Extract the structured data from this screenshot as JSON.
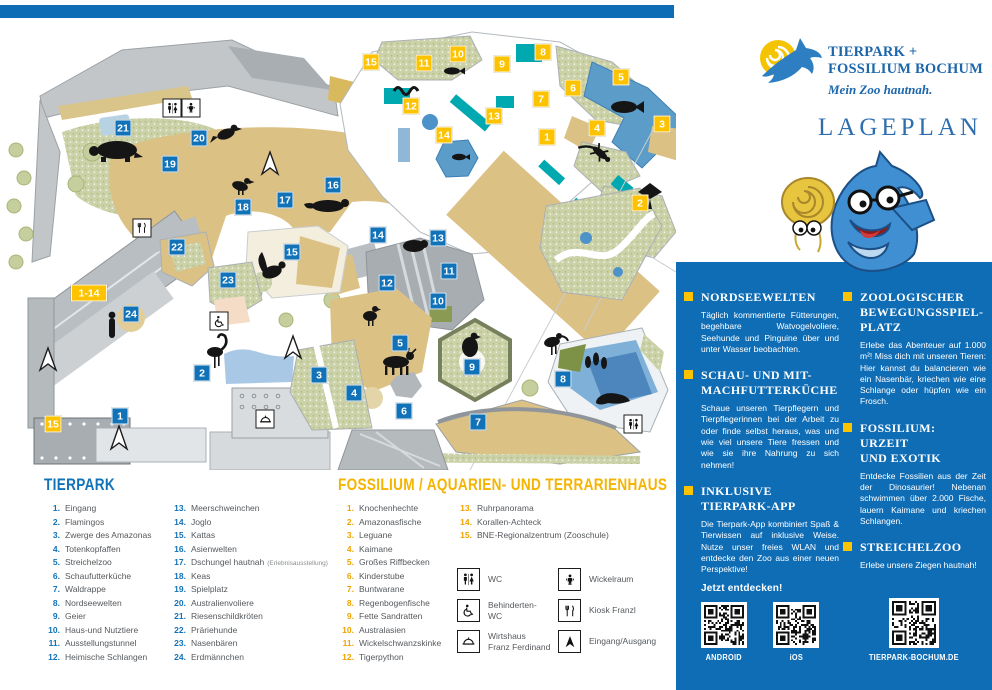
{
  "colors": {
    "brand_blue": "#0f6db6",
    "marker_blue": "#1272b8",
    "accent_yellow": "#fdc300"
  },
  "brand": {
    "line1": "TIERPARK +",
    "line2": "FOSSILIUM BOCHUM",
    "tagline": "Mein Zoo hautnah.",
    "page_title": "LAGEPLAN"
  },
  "sidebar": {
    "sections_left": [
      {
        "title": "NORDSEEWELTEN",
        "body": "Täglich kommentierte Fütterungen, begehbare Watvogelvoliere, Seehunde und Pinguine über und unter Wasser beobachten."
      },
      {
        "title": "SCHAU- UND MIT-\nMACHFUTTERKÜCHE",
        "body": "Schaue unseren Tierpflegern und Tierpflegerinnen bei der Arbeit zu oder finde selbst heraus, was und wie viel unsere Tiere fressen und wie sie ihre Nahrung zu sich nehmen!"
      },
      {
        "title": "INKLUSIVE\nTIERPARK-APP",
        "body": "Die Tierpark-App kombiniert Spaß & Tierwissen auf inklusive Weise. Nutze unser freies WLAN und entdecke den Zoo aus einer neuen Perspektive!",
        "cta": "Jetzt entdecken!"
      }
    ],
    "sections_right": [
      {
        "title": "ZOOLOGISCHER\nBEWEGUNGSSPIEL-\nPLATZ",
        "body": "Erlebe das Abenteuer auf 1.000 m²! Miss dich mit unseren Tieren: Hier kannst du balancieren wie ein Nasenbär, kriechen wie eine Schlange oder hüpfen wie ein Frosch."
      },
      {
        "title": "FOSSILIUM: URZEIT\nUND EXOTIK",
        "body": "Entdecke Fossilien aus der Zeit der Dinosaurier! Nebenan schwimmen über 2.000 Fische, lauern Kaimane und kriechen Schlangen."
      },
      {
        "title": "STREICHELZOO",
        "body": "Erlebe unsere Ziegen hautnah!"
      }
    ],
    "qr_labels": {
      "android": "ANDROID",
      "ios": "iOS",
      "web": "TIERPARK-BOCHUM.DE"
    }
  },
  "legend_tierpark": {
    "title": "TIERPARK",
    "col1": [
      {
        "n": "1.",
        "label": "Eingang"
      },
      {
        "n": "2.",
        "label": "Flamingos"
      },
      {
        "n": "3.",
        "label": "Zwerge des Amazonas"
      },
      {
        "n": "4.",
        "label": "Totenkopfaffen"
      },
      {
        "n": "5.",
        "label": "Streichelzoo"
      },
      {
        "n": "6.",
        "label": "Schaufutterküche"
      },
      {
        "n": "7.",
        "label": "Waldrappe"
      },
      {
        "n": "8.",
        "label": "Nordseewelten"
      },
      {
        "n": "9.",
        "label": "Geier"
      },
      {
        "n": "10.",
        "label": "Haus-und Nutztiere"
      },
      {
        "n": "11.",
        "label": "Ausstellungstunnel"
      },
      {
        "n": "12.",
        "label": "Heimische Schlangen"
      }
    ],
    "col2": [
      {
        "n": "13.",
        "label": "Meerschweinchen"
      },
      {
        "n": "14.",
        "label": "Joglo"
      },
      {
        "n": "15.",
        "label": "Kattas"
      },
      {
        "n": "16.",
        "label": "Asienwelten"
      },
      {
        "n": "17.",
        "label": "Dschungel hautnah",
        "note": "(Erlebnisausstellung)"
      },
      {
        "n": "18.",
        "label": "Keas"
      },
      {
        "n": "19.",
        "label": "Spielplatz"
      },
      {
        "n": "20.",
        "label": "Australienvoliere"
      },
      {
        "n": "21.",
        "label": "Riesenschildkröten"
      },
      {
        "n": "22.",
        "label": "Präriehunde"
      },
      {
        "n": "23.",
        "label": "Nasenbären"
      },
      {
        "n": "24.",
        "label": "Erdmännchen"
      }
    ]
  },
  "legend_fossilium": {
    "title": "FOSSILIUM / AQUARIEN- UND TERRARIENHAUS",
    "col1": [
      {
        "n": "1.",
        "label": "Knochenhechte"
      },
      {
        "n": "2.",
        "label": "Amazonasfische"
      },
      {
        "n": "3.",
        "label": "Leguane"
      },
      {
        "n": "4.",
        "label": "Kaimane"
      },
      {
        "n": "5.",
        "label": "Großes Riffbecken"
      },
      {
        "n": "6.",
        "label": "Kinderstube"
      },
      {
        "n": "7.",
        "label": "Buntwarane"
      },
      {
        "n": "8.",
        "label": "Regenbogenfische"
      },
      {
        "n": "9.",
        "label": "Fette Sandratten"
      },
      {
        "n": "10.",
        "label": "Australasien"
      },
      {
        "n": "11.",
        "label": "Wickelschwanzskinke"
      },
      {
        "n": "12.",
        "label": "Tigerpython"
      }
    ],
    "col2": [
      {
        "n": "13.",
        "label": "Ruhrpanorama"
      },
      {
        "n": "14.",
        "label": "Korallen-Achteck"
      },
      {
        "n": "15.",
        "label": "BNE-Regionalzentrum (Zooschule)"
      }
    ]
  },
  "facilities": {
    "wc": "WC",
    "behinderten_wc": "Behinderten-\nWC",
    "wirtshaus": "Wirtshaus\nFranz Ferdinand",
    "wickelraum": "Wickelraum",
    "kiosk": "Kiosk Franzl",
    "eingang": "Eingang/Ausgang"
  },
  "map": {
    "range_marker": {
      "label": "1-14",
      "x": 89,
      "y": 293
    },
    "markers": [
      {
        "n": "21",
        "x": 123,
        "y": 128,
        "type": "blue"
      },
      {
        "n": "20",
        "x": 199,
        "y": 138,
        "type": "blue"
      },
      {
        "n": "19",
        "x": 170,
        "y": 164,
        "type": "blue"
      },
      {
        "n": "18",
        "x": 243,
        "y": 207,
        "type": "blue"
      },
      {
        "n": "17",
        "x": 285,
        "y": 200,
        "type": "blue"
      },
      {
        "n": "16",
        "x": 333,
        "y": 185,
        "type": "blue"
      },
      {
        "n": "22",
        "x": 177,
        "y": 247,
        "type": "blue"
      },
      {
        "n": "23",
        "x": 228,
        "y": 280,
        "type": "blue"
      },
      {
        "n": "24",
        "x": 131,
        "y": 314,
        "type": "blue"
      },
      {
        "n": "15",
        "x": 292,
        "y": 252,
        "type": "blue"
      },
      {
        "n": "14",
        "x": 378,
        "y": 235,
        "type": "blue"
      },
      {
        "n": "13",
        "x": 438,
        "y": 238,
        "type": "blue"
      },
      {
        "n": "12",
        "x": 387,
        "y": 283,
        "type": "blue"
      },
      {
        "n": "11",
        "x": 449,
        "y": 271,
        "type": "blue"
      },
      {
        "n": "10",
        "x": 438,
        "y": 301,
        "type": "blue"
      },
      {
        "n": "5",
        "x": 400,
        "y": 343,
        "type": "blue"
      },
      {
        "n": "9",
        "x": 472,
        "y": 367,
        "type": "blue"
      },
      {
        "n": "3",
        "x": 319,
        "y": 375,
        "type": "blue"
      },
      {
        "n": "4",
        "x": 354,
        "y": 393,
        "type": "blue"
      },
      {
        "n": "6",
        "x": 404,
        "y": 411,
        "type": "blue"
      },
      {
        "n": "7",
        "x": 478,
        "y": 422,
        "type": "blue"
      },
      {
        "n": "8",
        "x": 563,
        "y": 379,
        "type": "blue"
      },
      {
        "n": "2",
        "x": 202,
        "y": 373,
        "type": "blue"
      },
      {
        "n": "1",
        "x": 120,
        "y": 416,
        "type": "blue"
      },
      {
        "n": "15",
        "x": 371,
        "y": 62,
        "type": "yellow"
      },
      {
        "n": "11",
        "x": 424,
        "y": 63,
        "type": "yellow"
      },
      {
        "n": "10",
        "x": 458,
        "y": 54,
        "type": "yellow"
      },
      {
        "n": "9",
        "x": 502,
        "y": 64,
        "type": "yellow"
      },
      {
        "n": "8",
        "x": 543,
        "y": 52,
        "type": "yellow"
      },
      {
        "n": "12",
        "x": 411,
        "y": 106,
        "type": "yellow"
      },
      {
        "n": "14",
        "x": 444,
        "y": 135,
        "type": "yellow"
      },
      {
        "n": "13",
        "x": 494,
        "y": 116,
        "type": "yellow"
      },
      {
        "n": "7",
        "x": 541,
        "y": 99,
        "type": "yellow"
      },
      {
        "n": "6",
        "x": 573,
        "y": 88,
        "type": "yellow"
      },
      {
        "n": "5",
        "x": 621,
        "y": 77,
        "type": "yellow"
      },
      {
        "n": "1",
        "x": 547,
        "y": 137,
        "type": "yellow"
      },
      {
        "n": "4",
        "x": 597,
        "y": 128,
        "type": "yellow"
      },
      {
        "n": "3",
        "x": 662,
        "y": 124,
        "type": "yellow"
      },
      {
        "n": "2",
        "x": 640,
        "y": 203,
        "type": "yellow"
      },
      {
        "n": "15",
        "x": 53,
        "y": 424,
        "type": "yellow"
      }
    ]
  }
}
